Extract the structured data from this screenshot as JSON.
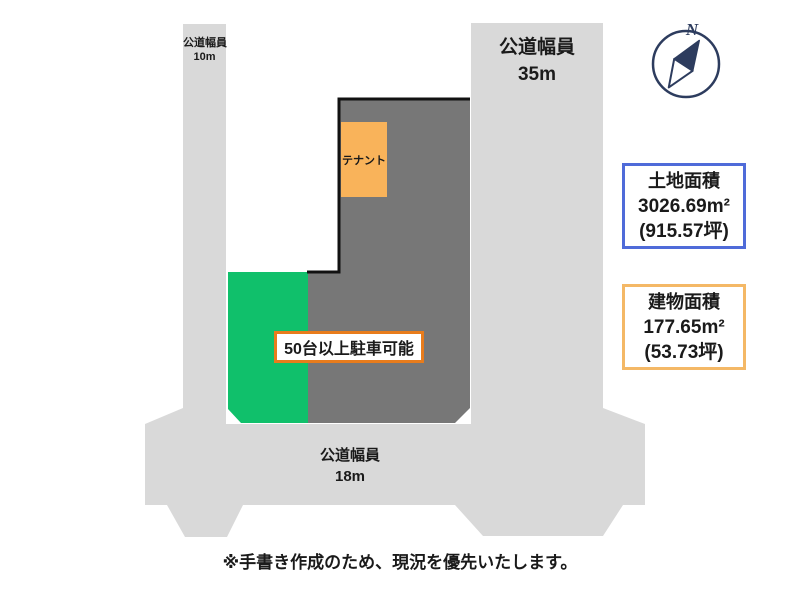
{
  "colors": {
    "road_gray": "#d9d9d9",
    "parcel_gray": "#777777",
    "parking_green": "#10c06b",
    "tenant_orange": "#f9b35a",
    "sign_border_orange": "#e87c1c",
    "land_box_blue": "#4f6bd9",
    "building_box_orange": "#f4b866",
    "compass_navy": "#2d3c5e"
  },
  "roads": {
    "left": {
      "name_label": "公道幅員",
      "width_label": "10m"
    },
    "right": {
      "name_label": "公道幅員",
      "width_label": "35m"
    },
    "bottom": {
      "name_label": "公道幅員",
      "width_label": "18m"
    }
  },
  "tenant": {
    "label": "テナント"
  },
  "parking_sign": {
    "label": "50台以上駐車可能"
  },
  "land_area_box": {
    "title": "土地面積",
    "area_m2": "3026.69m²",
    "area_tsubo": "(915.57坪)"
  },
  "building_area_box": {
    "title": "建物面積",
    "area_m2": "177.65m²",
    "area_tsubo": "(53.73坪)"
  },
  "compass": {
    "label": "N"
  },
  "footnote": "※手書き作成のため、現況を優先いたします。"
}
